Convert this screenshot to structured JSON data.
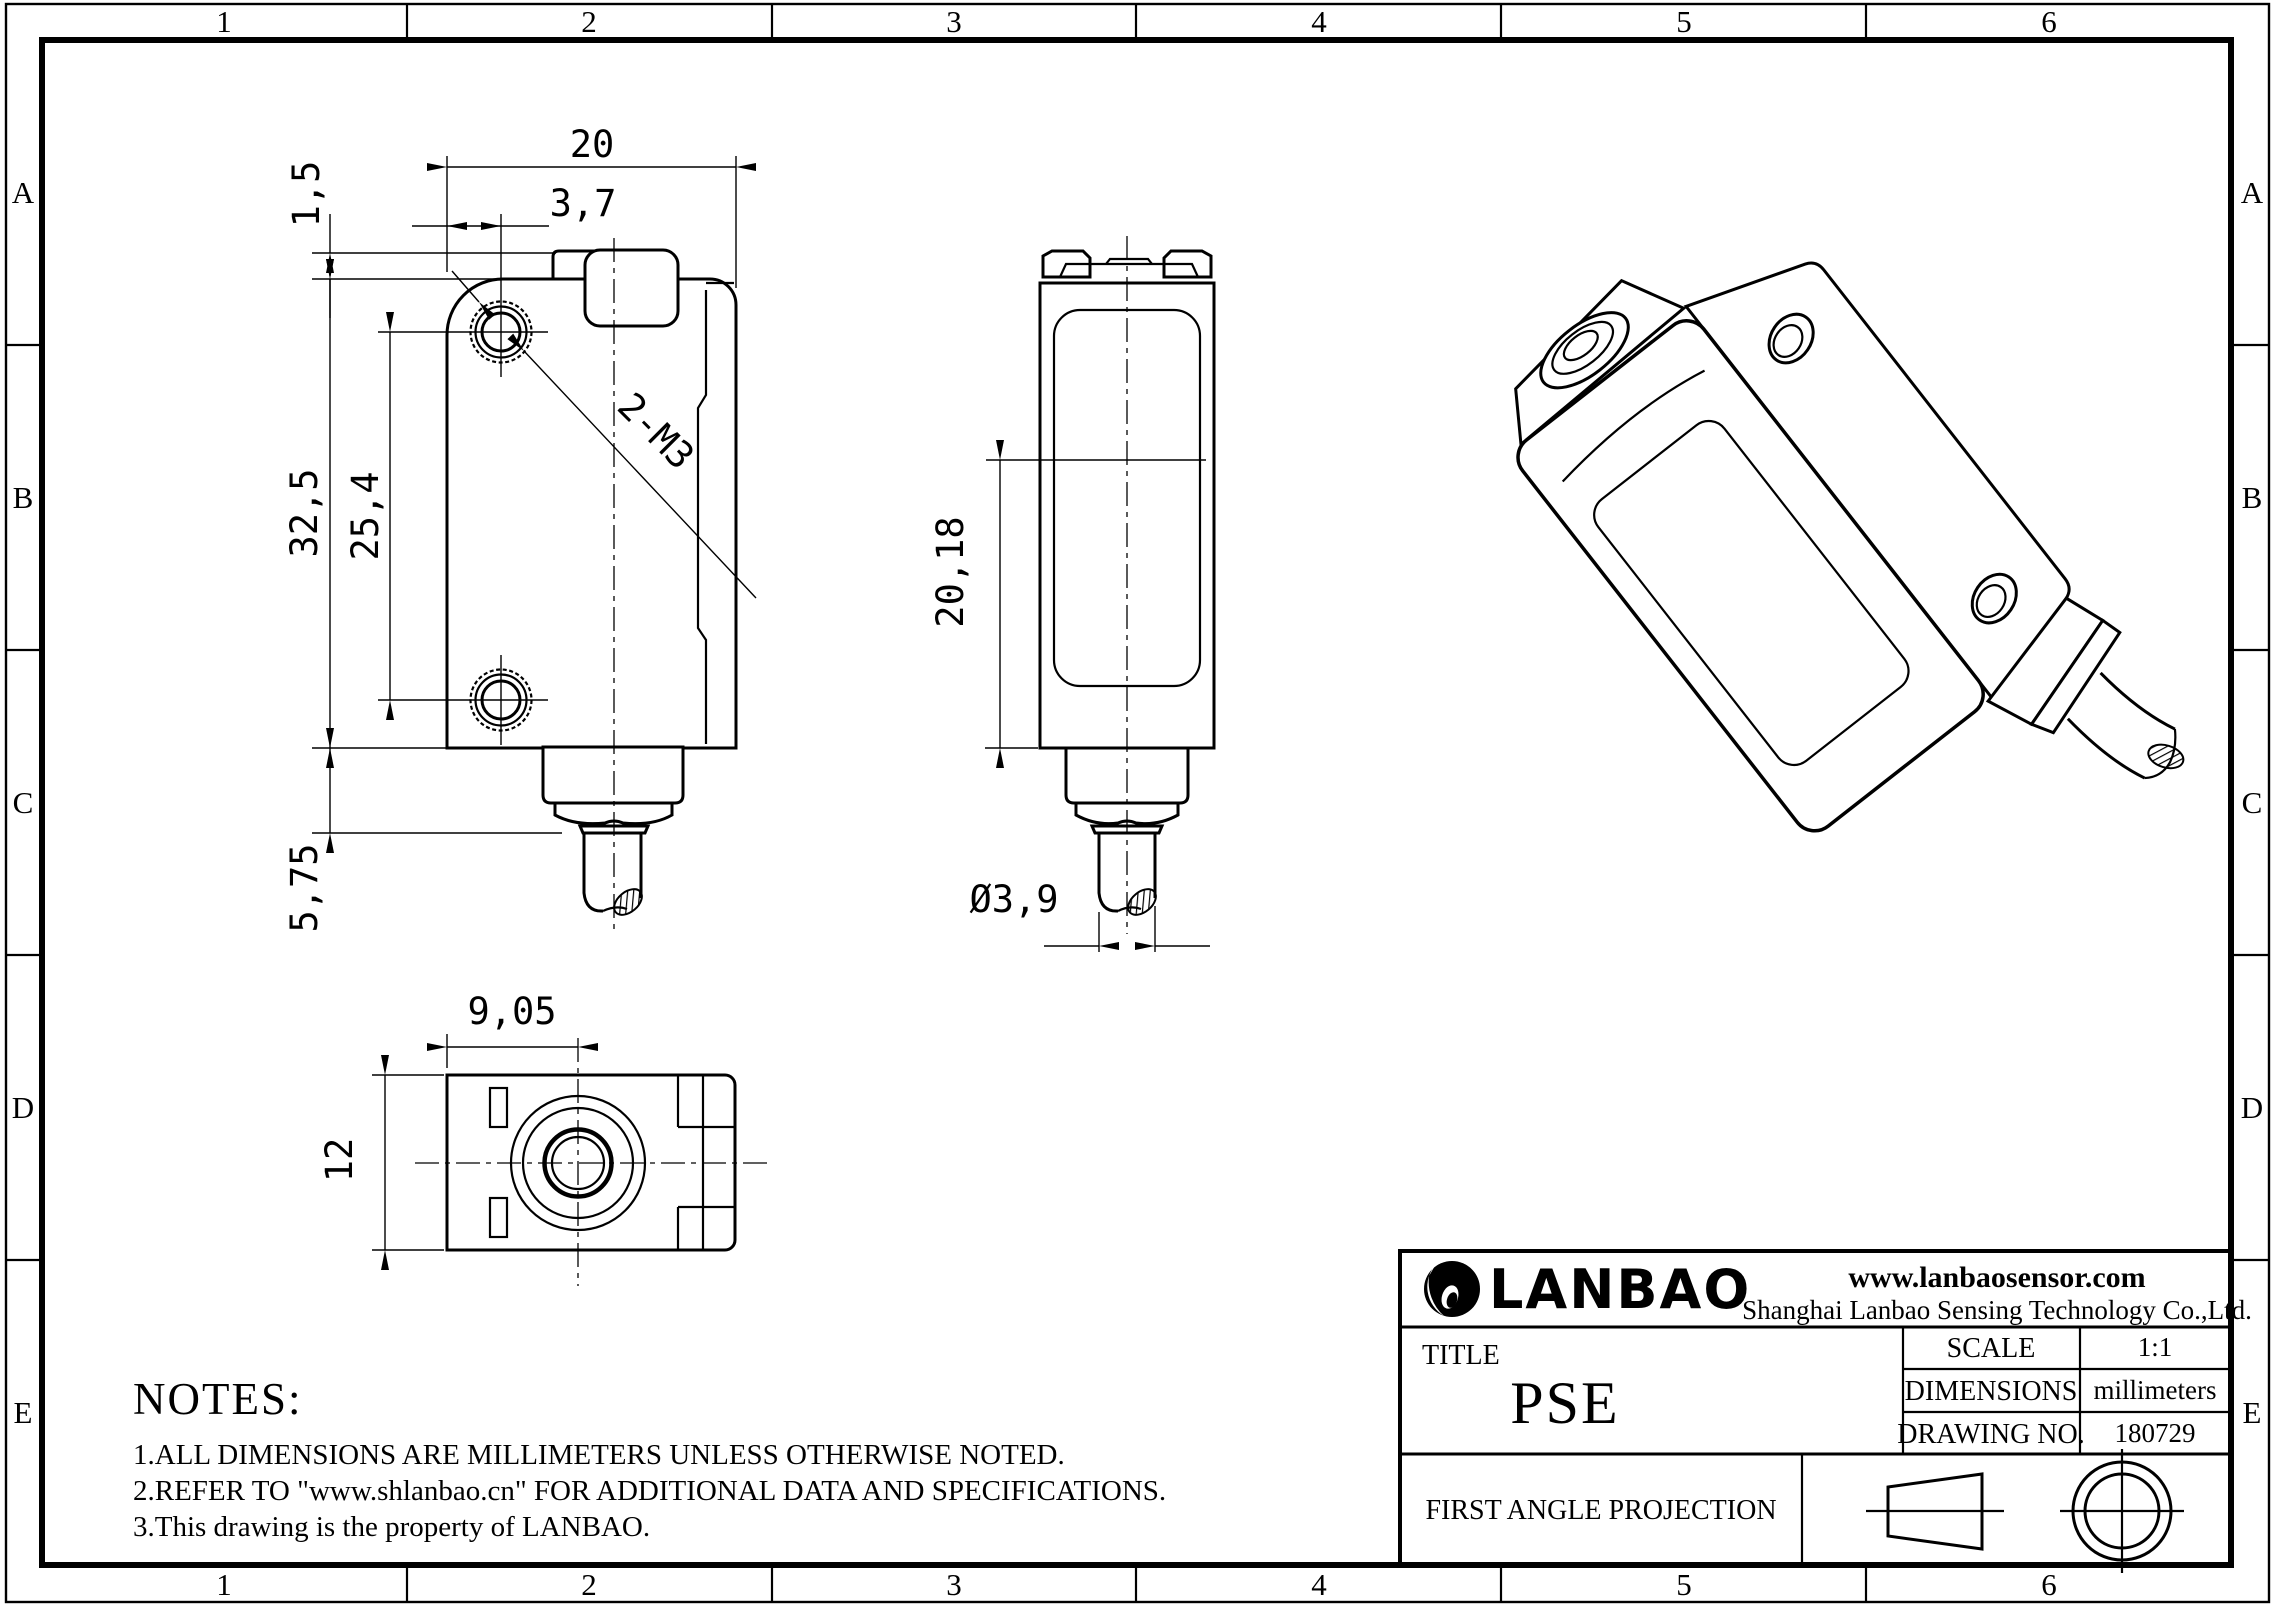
{
  "zones": {
    "columns": [
      "1",
      "2",
      "3",
      "4",
      "5",
      "6"
    ],
    "rows": [
      "A",
      "B",
      "C",
      "D",
      "E"
    ]
  },
  "front_view": {
    "dim_width": "20",
    "dim_hole_offset": "3,7",
    "dim_head_step": "1,5",
    "dim_body_height": "32,5",
    "dim_hole_spacing": "25,4",
    "dim_connector_height": "5,75",
    "thread_callout": "2-M3"
  },
  "side_view": {
    "dim_axis_to_bottom": "20,18",
    "dim_cable_diameter": "Ø3,9"
  },
  "bottom_view": {
    "dim_lens_center": "9,05",
    "dim_depth": "12"
  },
  "notes": {
    "heading": "NOTES:",
    "item1": "1.ALL DIMENSIONS ARE MILLIMETERS UNLESS OTHERWISE NOTED.",
    "item2": "2.REFER TO \"www.shlanbao.cn\" FOR ADDITIONAL DATA AND SPECIFICATIONS.",
    "item3": "3.This drawing is the property of LANBAO."
  },
  "title_block": {
    "brand": "LANBAO",
    "website": "www.lanbaosensor.com",
    "company": "Shanghai Lanbao Sensing Technology Co.,Ltd.",
    "title_label": "TITLE",
    "title": "PSE",
    "scale_label": "SCALE",
    "scale_value": "1:1",
    "dimensions_label": "DIMENSIONS",
    "dimensions_value": "millimeters",
    "drawing_no_label": "DRAWING NO.",
    "drawing_no_value": "180729",
    "projection_label": "FIRST ANGLE PROJECTION"
  },
  "colors": {
    "line_color": "#000000",
    "paper_color": "#ffffff"
  }
}
